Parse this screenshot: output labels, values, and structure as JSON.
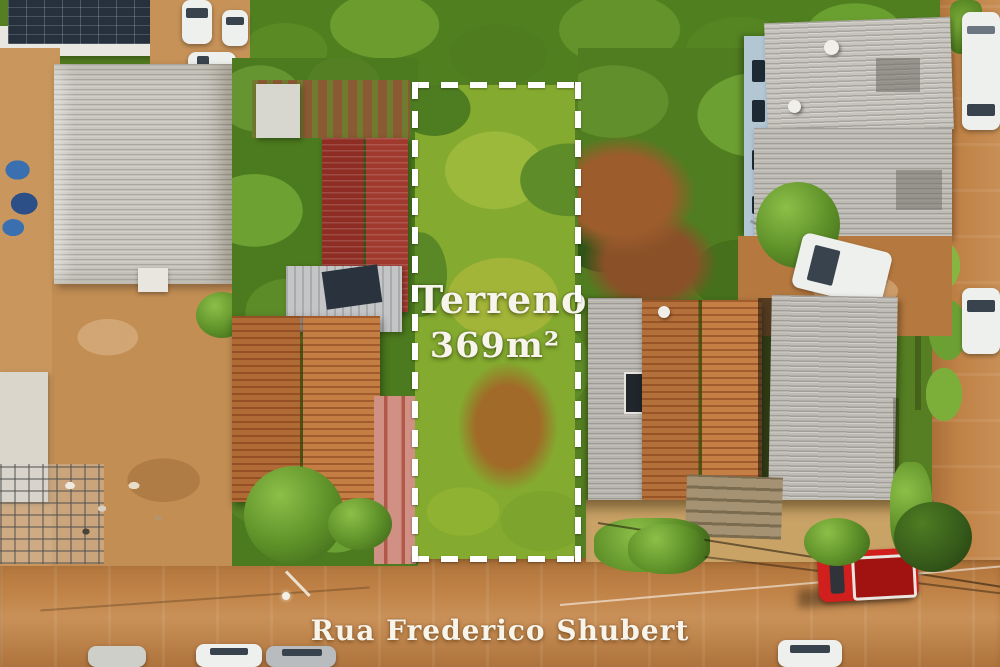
{
  "overlay": {
    "plot_label": "Terreno",
    "plot_area": "369m²",
    "street_name": "Rua Frederico Shubert"
  },
  "colors": {
    "forest_green": "#557f22",
    "plot_grass": "#84aa2f",
    "dirt_road": "#c08246",
    "red_roof": "#8e2d24",
    "orange_roof": "#b4703a",
    "gray_roof": "#c9c7bf",
    "pink_drive": "#d09084",
    "solar_panel": "#27313d",
    "truck_red": "#d01f1c",
    "plot_outline": "#ffffff",
    "text_white": "#f7f4ec"
  }
}
